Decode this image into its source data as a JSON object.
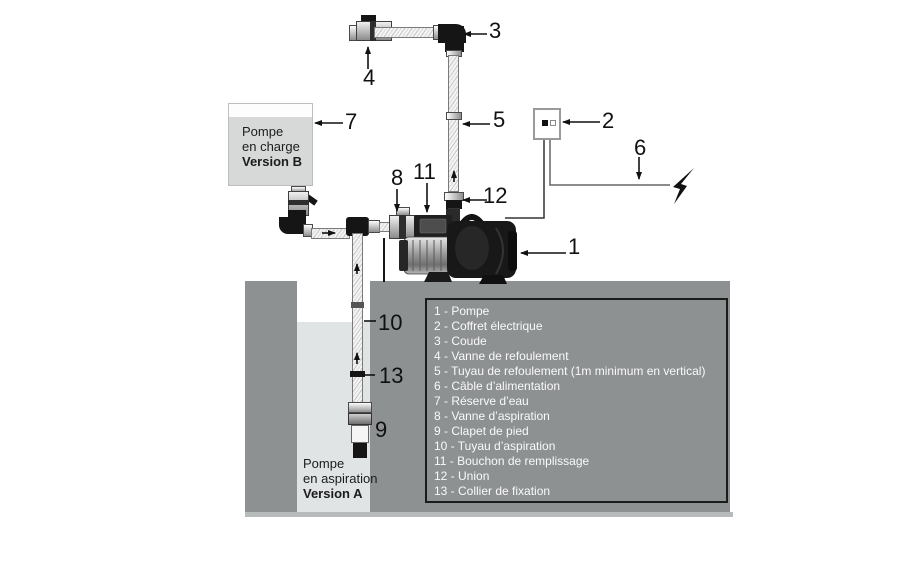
{
  "colors": {
    "ground": "#8d9191",
    "well_water": "#e0e4e4",
    "tank_fill": "#d7d9d9",
    "legend_border": "#1b1b1b",
    "legend_text": "#fafafa"
  },
  "captions": {
    "tank_b": {
      "line1": "Pompe",
      "line2": "en charge",
      "line3": "Version B"
    },
    "well_a": {
      "line1": "Pompe",
      "line2": "en aspiration",
      "line3": "Version A"
    }
  },
  "callouts": {
    "n1": "1",
    "n2": "2",
    "n3": "3",
    "n4": "4",
    "n5": "5",
    "n6": "6",
    "n7": "7",
    "n8": "8",
    "n9": "9",
    "n10": "10",
    "n11": "11",
    "n12": "12",
    "n13": "13"
  },
  "legend": {
    "items": [
      "1 - Pompe",
      "2 - Coffret électrique",
      "3 - Coude",
      "4 - Vanne de refoulement",
      "5 - Tuyau de refoulement (1m minimum en vertical)",
      "6 - Câble d’alimentation",
      "7 - Réserve d’eau",
      "8 - Vanne d’aspiration",
      "9 - Clapet de pied",
      "10 - Tuyau d’aspiration",
      "11 - Bouchon de remplissage",
      "12 - Union",
      "13 - Collier de fixation"
    ]
  }
}
